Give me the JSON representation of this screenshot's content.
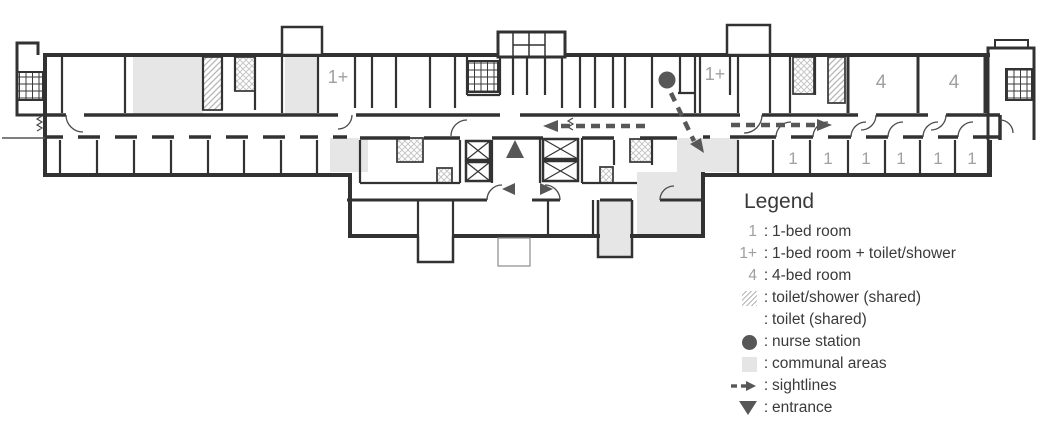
{
  "plan": {
    "room_labels": {
      "one_plus_left": "1+",
      "one_plus_right": "1+",
      "four_a": "4",
      "four_b": "4",
      "one_bed_1": "1",
      "one_bed_2": "1",
      "one_bed_3": "1",
      "one_bed_4": "1",
      "one_bed_5": "1",
      "one_bed_6": "1"
    }
  },
  "legend": {
    "title": "Legend",
    "separator": ":",
    "items": [
      {
        "symbol": "1",
        "label": "1-bed room"
      },
      {
        "symbol": "1+",
        "label": "1-bed room + toilet/shower"
      },
      {
        "symbol": "4",
        "label": "4-bed room"
      },
      {
        "symbol": "diagonal-hatch",
        "label": "toilet/shower (shared)"
      },
      {
        "symbol": "cross-hatch",
        "label": "toilet (shared)"
      },
      {
        "symbol": "nurse-station-dot",
        "label": "nurse station"
      },
      {
        "symbol": "communal-area-swatch",
        "label": "communal areas"
      },
      {
        "symbol": "sightline-arrow",
        "label": "sightlines"
      },
      {
        "symbol": "entrance-triangle",
        "label": "entrance"
      }
    ]
  },
  "colors": {
    "wall": "#323232",
    "room_label": "#a0a0a0",
    "marker": "#575757",
    "communal_fill": "#e6e6e6",
    "hatch_line": "#b5b5b5",
    "legend_text": "#3a3a3a"
  }
}
